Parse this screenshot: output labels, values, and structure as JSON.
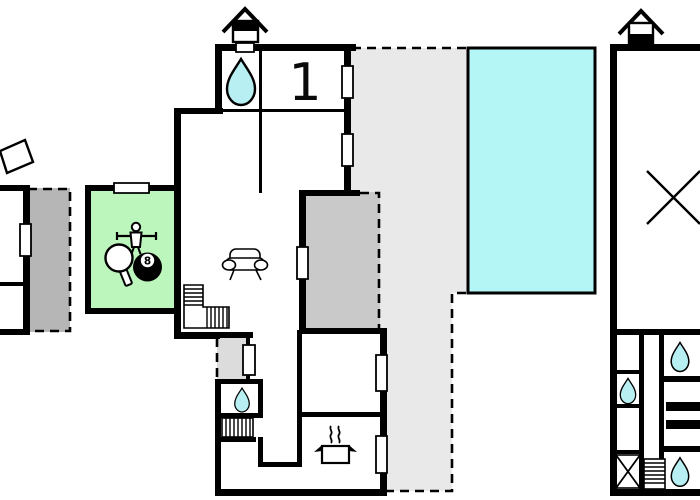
{
  "floor_plan": {
    "labels": {
      "room_number": "1",
      "billiard_ball_number": "8"
    },
    "colors": {
      "wall": "#000000",
      "background": "#ffffff",
      "pool_water": "#b4f6f6",
      "water_drop": "#b8eff2",
      "game_room": "#bdf6bd",
      "terrace": "#e9e9e9",
      "covered_annex": "#c9c9c9",
      "side_annex": "#b6b6b6",
      "entrance_porch": "#dcdcdc",
      "window": "#ffffff"
    },
    "icons": [
      "chimney-icon",
      "shower-drop-icon",
      "foosball-player-icon",
      "table-tennis-paddle-icon",
      "billiard-8ball-icon",
      "sofa-icon",
      "staircase-icon",
      "stove-icon",
      "cross-marker-icon",
      "window-marker"
    ]
  }
}
